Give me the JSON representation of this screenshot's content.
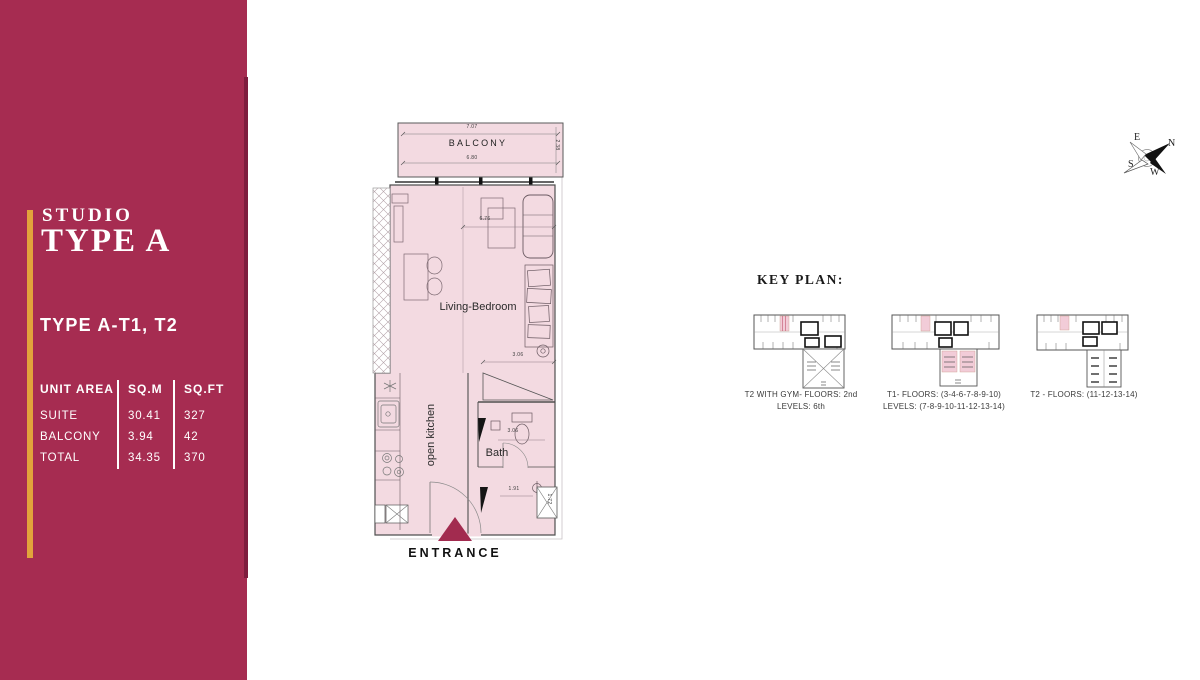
{
  "sidebar": {
    "bg_color": "#A62C51",
    "accent_color": "#E2A33B",
    "eyebrow": "STUDIO",
    "title": "TYPE A",
    "subtitle": "TYPE A-T1, T2",
    "area_table": {
      "headers": [
        "UNIT AREA",
        "SQ.M",
        "SQ.FT"
      ],
      "rows": [
        {
          "label": "SUITE",
          "sqm": "30.41",
          "sqft": "327"
        },
        {
          "label": "BALCONY",
          "sqm": "3.94",
          "sqft": "42"
        },
        {
          "label": "TOTAL",
          "sqm": "34.35",
          "sqft": "370"
        }
      ]
    }
  },
  "floorplan": {
    "fill_color": "#F3DAE1",
    "entrance_arrow_color": "#A22B4F",
    "labels": {
      "balcony": "BALCONY",
      "living": "Living-Bedroom",
      "kitchen": "open kitchen",
      "bath": "Bath",
      "entrance": "ENTRANCE"
    },
    "dimensions": {
      "balcony_width": "7.07",
      "balcony_inner_width": "6.80",
      "balcony_depth": "2.38",
      "living_width": "6.76",
      "living_depth": "3.06",
      "bath_width": "3.06",
      "entry_width": "1.91",
      "entry_depth": "1.72"
    }
  },
  "key_plan": {
    "title": "KEY PLAN:",
    "highlight_color": "#F2CCD8",
    "plans": [
      {
        "caption_line1": "T2 WITH GYM- FLOORS: 2nd",
        "caption_line2": "LEVELS: 6th"
      },
      {
        "caption_line1": "T1- FLOORS: (3-4-6-7-8-9-10)",
        "caption_line2": "LEVELS: (7-8-9-10-11-12-13-14)"
      },
      {
        "caption_line1": "T2 - FLOORS: (11-12-13-14)",
        "caption_line2": ""
      }
    ]
  },
  "compass": {
    "north": "N",
    "east": "E",
    "south": "S",
    "west": "W"
  }
}
